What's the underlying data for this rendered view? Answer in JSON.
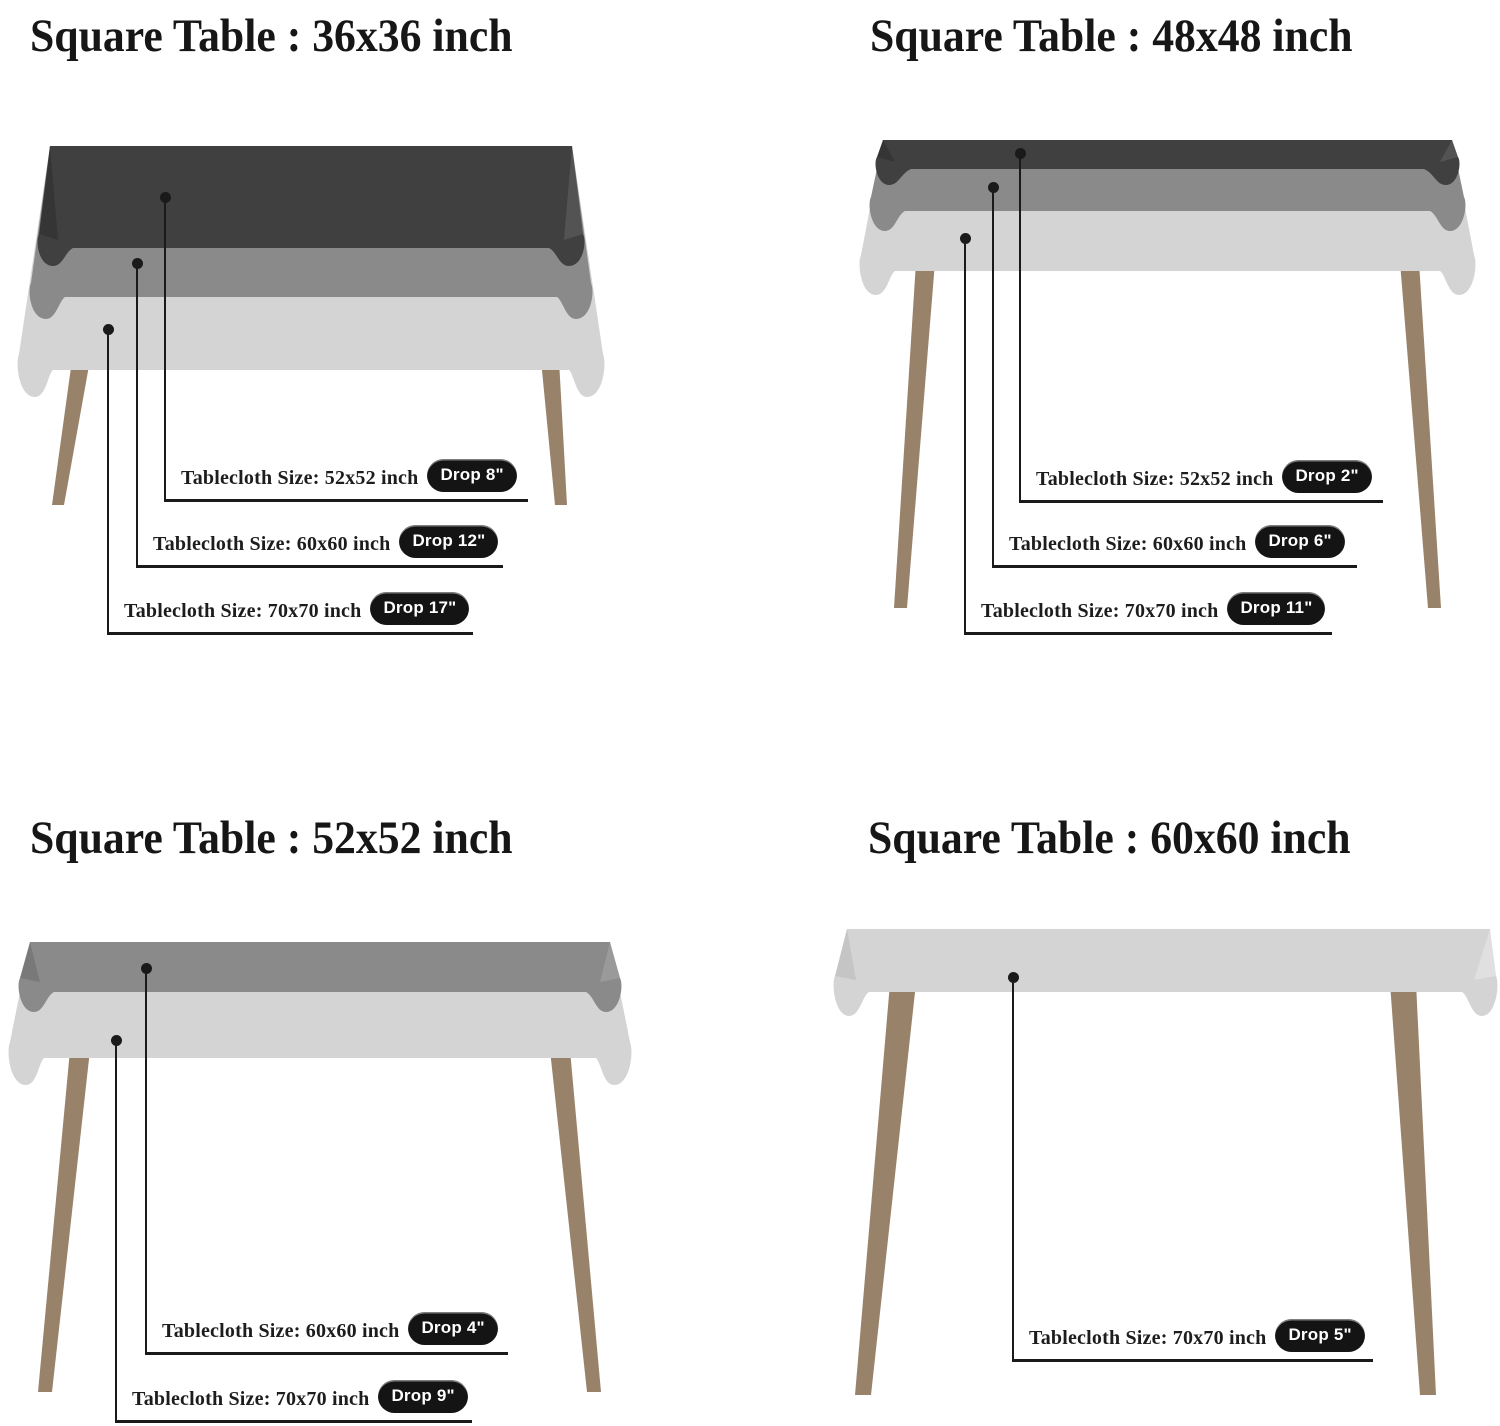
{
  "page": {
    "background": "#ffffff"
  },
  "colors": {
    "dark_cloth": "#404040",
    "medium_cloth": "#8a8a8a",
    "light_cloth": "#d4d4d4",
    "table_leg": "#99826a",
    "callout_line": "#1a1a1a",
    "pill_background": "#141414",
    "pill_text": "#ffffff",
    "title_text": "#161616",
    "label_text": "#1d1d1d"
  },
  "quadrants": [
    {
      "id": "table-36x36",
      "title": "Square Table : 36x36 inch",
      "callouts": [
        {
          "label": "Tablecloth Size: 52x52 inch",
          "drop": "Drop 8\""
        },
        {
          "label": "Tablecloth Size: 60x60 inch",
          "drop": "Drop 12\""
        },
        {
          "label": "Tablecloth Size: 70x70 inch",
          "drop": "Drop 17\""
        }
      ]
    },
    {
      "id": "table-48x48",
      "title": "Square Table : 48x48 inch",
      "callouts": [
        {
          "label": "Tablecloth Size: 52x52 inch",
          "drop": "Drop 2\""
        },
        {
          "label": "Tablecloth Size: 60x60 inch",
          "drop": "Drop 6\""
        },
        {
          "label": "Tablecloth Size: 70x70 inch",
          "drop": "Drop 11\""
        }
      ]
    },
    {
      "id": "table-52x52",
      "title": "Square Table : 52x52 inch",
      "callouts": [
        {
          "label": "Tablecloth Size: 60x60 inch",
          "drop": "Drop 4\""
        },
        {
          "label": "Tablecloth Size: 70x70 inch",
          "drop": "Drop 9\""
        }
      ]
    },
    {
      "id": "table-60x60",
      "title": "Square Table : 60x60 inch",
      "callouts": [
        {
          "label": "Tablecloth Size: 70x70 inch",
          "drop": "Drop 5\""
        }
      ]
    }
  ]
}
